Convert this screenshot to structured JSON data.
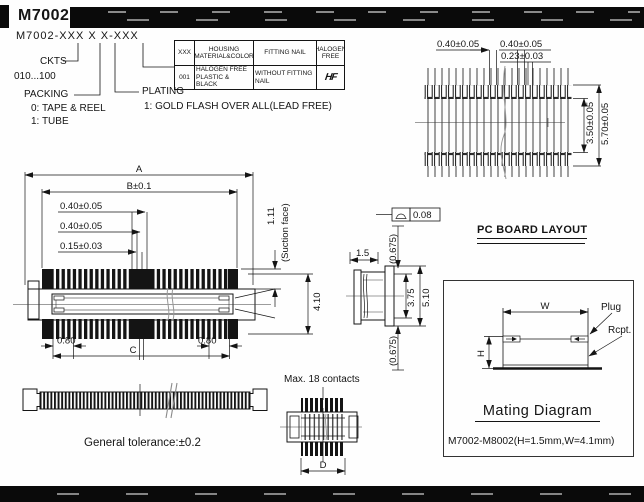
{
  "header": {
    "title": "M7002"
  },
  "legend": {
    "code": "M7002-XXX X X-XXX",
    "ckts_label": "CKTS",
    "ckts_range": "010...100",
    "packing_label": "PACKING",
    "packing_opt0": "0: TAPE & REEL",
    "packing_opt1": "1: TUBE",
    "plating_label": "PLATING",
    "plating_opt1": "1: GOLD FLASH OVER ALL(LEAD FREE)"
  },
  "options_table": {
    "headers": [
      "XXX",
      "HOUSING MATERIAL&COLOR",
      "FITTING NAIL",
      "HALOGEN FREE"
    ],
    "row": [
      "001",
      "HALOGEN FREE PLASTIC & BLACK",
      "WITHOUT FITTING NAIL"
    ],
    "logo": "HF"
  },
  "footprint": {
    "pitch_left": "0.40±0.05",
    "pitch_right": "0.40±0.05",
    "pad_width": "0.23±0.03",
    "inner_span": "3.50±0.05",
    "outer_span": "5.70±0.05"
  },
  "front_view": {
    "dim_a": "A",
    "dim_b": "B±0.1",
    "pitch1": "0.40±0.05",
    "pitch2": "0.40±0.05",
    "pin_width": "0.15±0.03",
    "cap_height": "1.11",
    "suction": "(Suction face)",
    "total_height": "4.10",
    "end_left": "0.80",
    "end_right": "0.80",
    "dim_c": "C"
  },
  "side_view": {
    "width": "1.5",
    "top_offset": "(0.675)",
    "bottom_offset": "(0.675)",
    "inner_height": "3.75",
    "outer_height": "5.10",
    "flatness_tol": "0.08"
  },
  "pcb": {
    "title": "PC BOARD LAYOUT"
  },
  "mating": {
    "dim_w": "W",
    "dim_h": "H",
    "plug": "Plug",
    "rcpt": "Rcpt.",
    "title": "Mating Diagram",
    "note": "M7002-M8002(H=1.5mm,W=4.1mm)"
  },
  "bottom": {
    "max_contacts": "Max. 18 contacts",
    "dim_d": "D",
    "general_tolerance": "General tolerance:±0.2"
  }
}
